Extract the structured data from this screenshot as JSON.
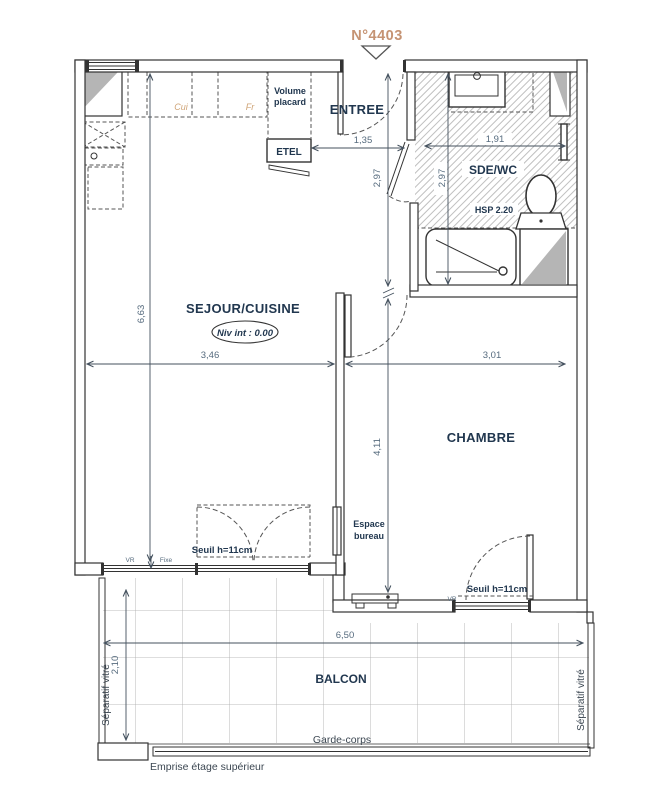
{
  "plan": {
    "unit_number": "N°4403",
    "rooms": {
      "entree": "ENTREE",
      "sde_wc": "SDE/WC",
      "sejour_cuisine": "SEJOUR/CUISINE",
      "chambre": "CHAMBRE",
      "balcon": "BALCON"
    },
    "annotations": {
      "niveau": "Niv int : 0.00",
      "hsp": "HSP 2.20",
      "volume_placard_1": "Volume",
      "volume_placard_2": "placard",
      "etel": "ETEL",
      "cui": "Cui",
      "fr": "Fr",
      "espace_bureau_1": "Espace",
      "espace_bureau_2": "bureau",
      "seuil_sejour": "Seuil h=11cm",
      "seuil_chambre": "Seuil h=11cm",
      "vr_sejour": "VR",
      "fixe": "Fixe",
      "vr_chambre": "VR",
      "separatif_left": "Séparatif vitré",
      "separatif_right": "Séparatif vitré",
      "garde_corps": "Garde-corps",
      "emprise": "Emprise étage supérieur"
    },
    "dimensions": {
      "entree_largeur": "1,35",
      "entree_profondeur": "2,97",
      "sde_profondeur": "2,97",
      "sde_largeur": "1,91",
      "sejour_longueur": "6,63",
      "sejour_largeur": "3,46",
      "chambre_largeur": "3,01",
      "chambre_longueur": "4,11",
      "balcon_largeur": "6,50",
      "balcon_profondeur": "2,10"
    },
    "colors": {
      "unit_number": "#c59373",
      "room_label": "#21374f",
      "dimension": "#566b7e",
      "kitchen_tag": "#cfa477",
      "hatch": "#bfbfbf",
      "shade": "#b5b5b5"
    }
  }
}
